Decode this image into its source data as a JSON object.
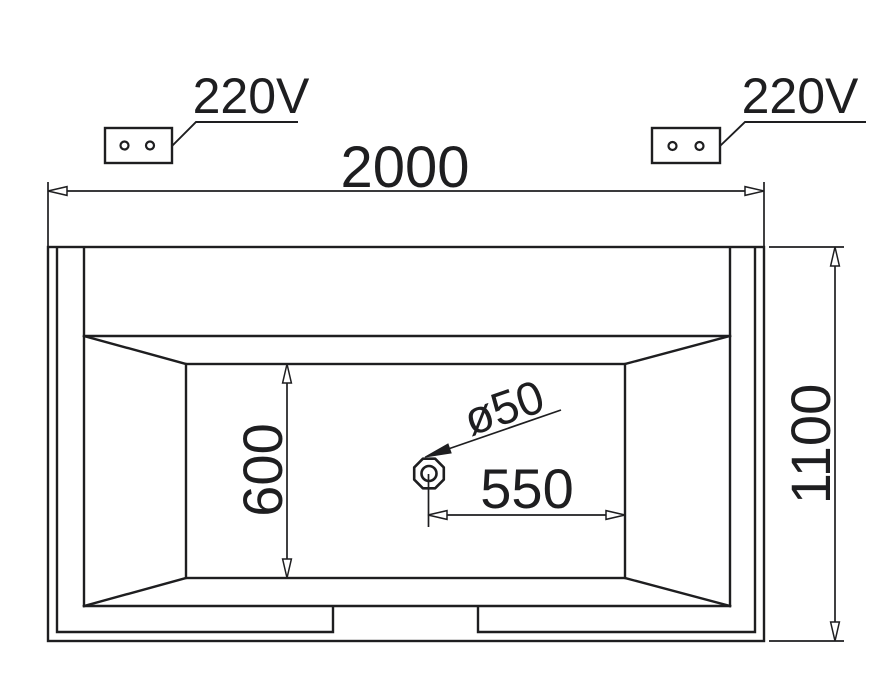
{
  "drawing": {
    "labels": {
      "outlet_left": "220V",
      "outlet_right": "220V",
      "overall_width": "2000",
      "overall_depth": "1100",
      "basin_inner_depth": "600",
      "drain_to_edge": "550",
      "drain_diameter": "ø50"
    },
    "colors": {
      "line": "#1e1e20",
      "background": "#ffffff"
    }
  }
}
